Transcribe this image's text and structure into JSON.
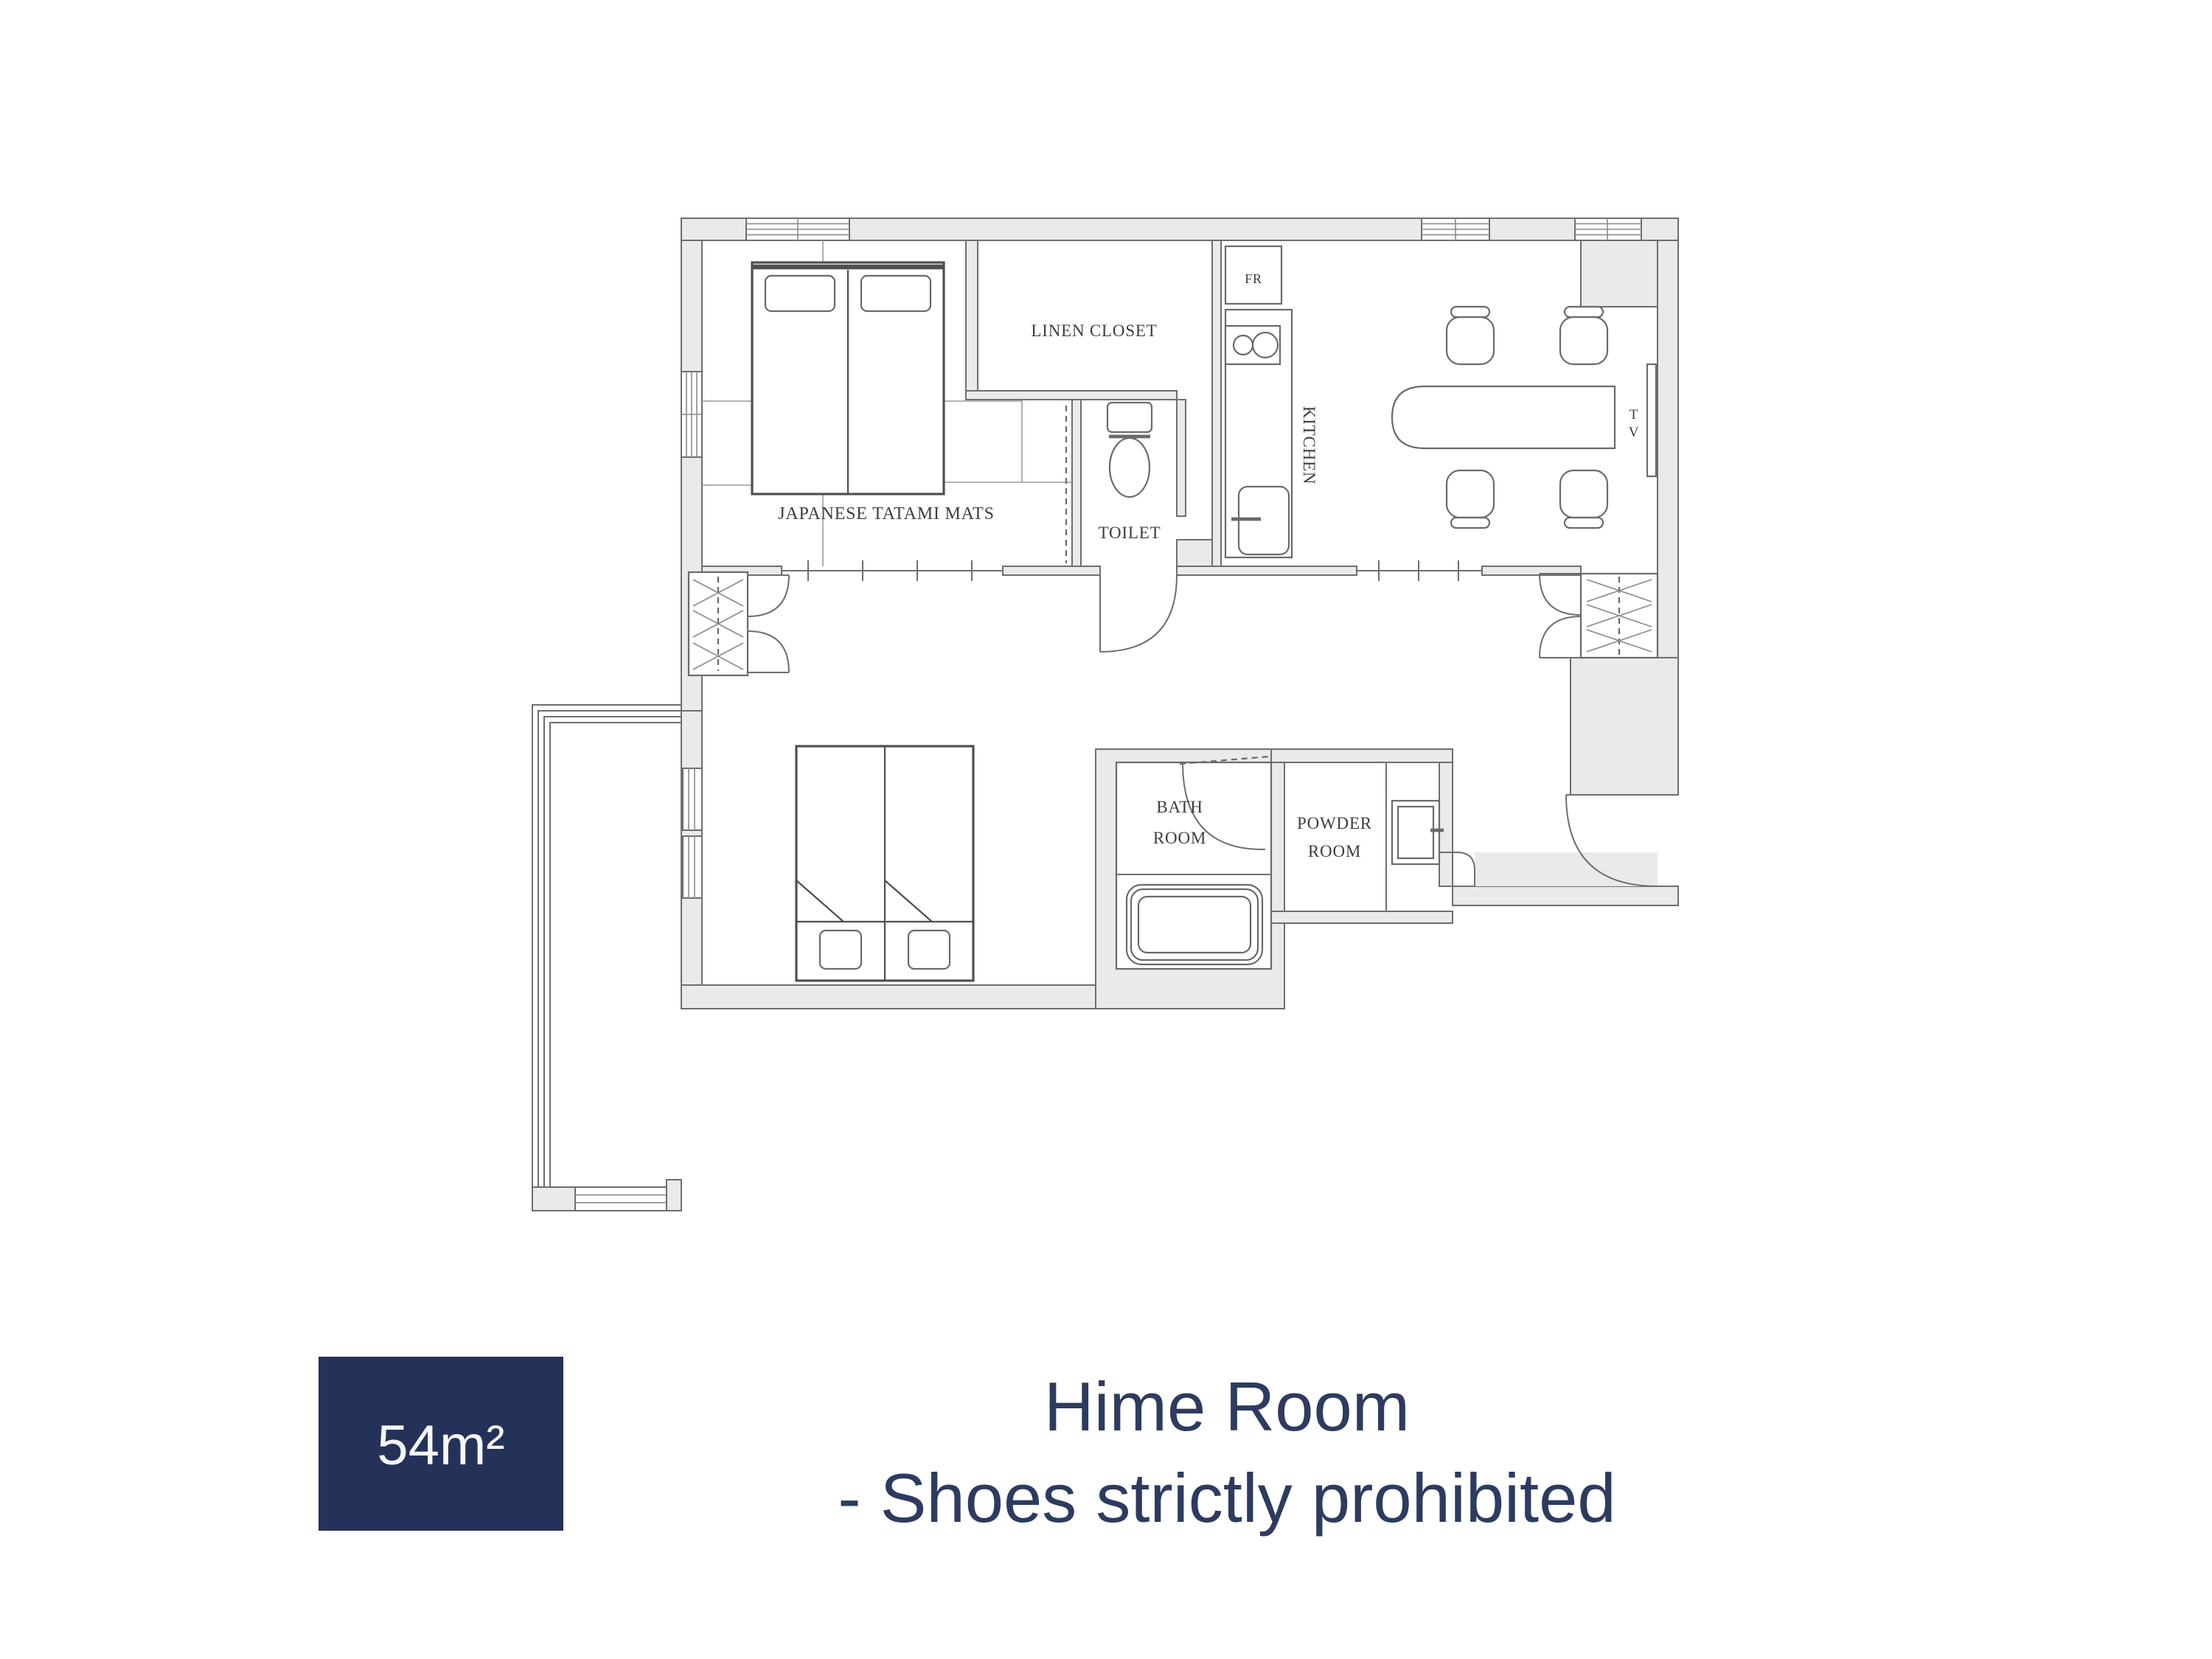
{
  "plan": {
    "labels": {
      "tatami": "JAPANESE TATAMI MATS",
      "linen_closet": "LINEN CLOSET",
      "toilet": "TOILET",
      "kitchen": "KITCHEN",
      "fridge": "FR",
      "tv": [
        "T",
        "V"
      ],
      "bath": [
        "BATH",
        "ROOM"
      ],
      "powder": [
        "POWDER",
        "ROOM"
      ]
    }
  },
  "footer": {
    "area_badge": "54m²",
    "title_line1": "Hime Room",
    "title_line2": "- Shoes strictly prohibited"
  },
  "colors": {
    "badge_bg": "#243259",
    "badge_text": "#f5f7fb",
    "title_text": "#2d3b60",
    "wall_fill": "#eaeaea",
    "line": "#6e6e6e",
    "label_text": "#3d3d3d"
  }
}
